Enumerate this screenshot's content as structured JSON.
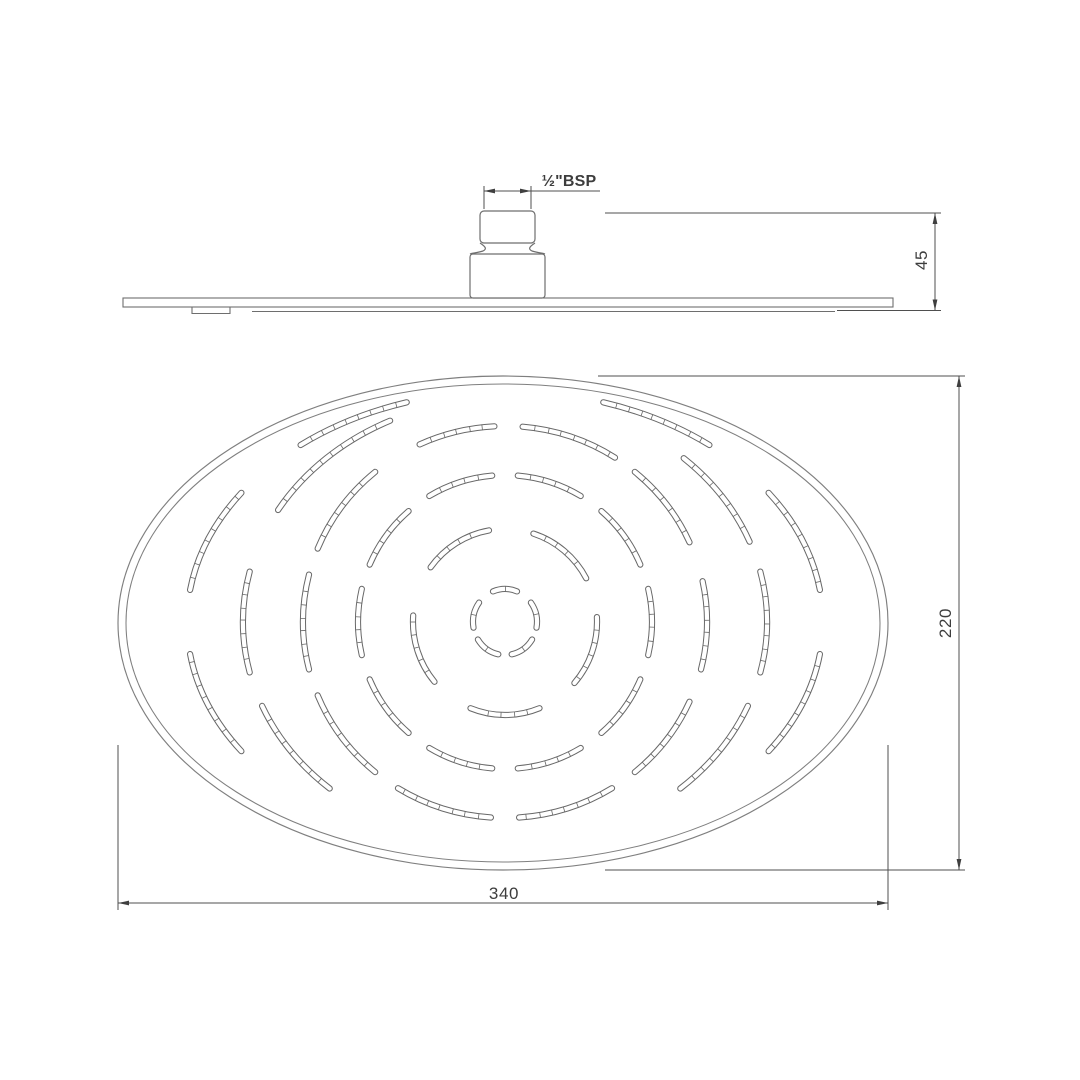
{
  "drawing": {
    "labels": {
      "thread": "½\"BSP",
      "connector_height": "45",
      "face_width": "340",
      "face_height": "220"
    },
    "colors": {
      "line": "#6e6e6e",
      "rim": "#7f7f7f",
      "slot": "#686868",
      "dim": "#4f4f4f",
      "arrow": "#3f3f3f",
      "text": "#3d3d3d",
      "background": "#ffffff"
    },
    "side_view": {
      "plate": {
        "x1": 123,
        "x2": 893,
        "y1": 298,
        "y2": 307
      },
      "under_line": {
        "x1": 252,
        "x2": 835,
        "y": 311.5
      },
      "under_tab": {
        "x1": 192,
        "x2": 230,
        "y1": 307,
        "y2": 313.5
      },
      "connector": {
        "upper": {
          "x": 480,
          "y": 211,
          "w": 55,
          "h": 32,
          "r": 4
        },
        "neck": {
          "top": 243,
          "bottom": 254,
          "in_left": 483,
          "in_right": 532
        },
        "lower": {
          "x": 470,
          "y": 254,
          "w": 75,
          "h": 44,
          "r": 3
        }
      }
    },
    "dimensions": {
      "bsp": {
        "ext": [
          {
            "x": 484,
            "y1": 186,
            "y2": 209
          },
          {
            "x": 531,
            "y1": 186,
            "y2": 209
          }
        ],
        "line": {
          "x1": 484,
          "x2": 600,
          "y": 191
        },
        "arrows": [
          {
            "x": 484,
            "y": 191,
            "dir": "l"
          },
          {
            "x": 531,
            "y": 191,
            "dir": "r"
          }
        ]
      },
      "h45": {
        "ext_h": [
          {
            "x1": 605,
            "x2": 941,
            "y": 213
          },
          {
            "x1": 837,
            "x2": 941,
            "y": 310.5
          }
        ],
        "line": {
          "x": 935,
          "y1": 213,
          "y2": 310.5
        },
        "arrows": [
          {
            "x": 935,
            "y": 213,
            "dir": "u"
          },
          {
            "x": 935,
            "y": 310.5,
            "dir": "d"
          }
        ]
      },
      "w340": {
        "ext_v": [
          {
            "x": 118,
            "y1": 745,
            "y2": 910
          },
          {
            "x": 888,
            "y1": 745,
            "y2": 910
          }
        ],
        "line": {
          "x1": 118,
          "x2": 888,
          "y": 903
        },
        "arrows": [
          {
            "x": 118,
            "y": 903,
            "dir": "l"
          },
          {
            "x": 888,
            "y": 903,
            "dir": "r"
          }
        ]
      },
      "h220": {
        "ext_h": [
          {
            "x1": 598,
            "x2": 965,
            "y": 376
          },
          {
            "x1": 605,
            "x2": 965,
            "y": 870
          }
        ],
        "line": {
          "x": 959,
          "y1": 376,
          "y2": 870
        },
        "arrows": [
          {
            "x": 959,
            "y": 376,
            "dir": "u"
          },
          {
            "x": 959,
            "y": 870,
            "dir": "d"
          }
        ]
      }
    },
    "face_view": {
      "cx": 503,
      "cy": 623,
      "outer": {
        "rx": 385,
        "ry": 247
      },
      "inner": {
        "rx": 377,
        "ry": 239
      },
      "pattern_center": {
        "x": 505,
        "y": 622
      },
      "slot_width_outer": 6.2,
      "slot_width_inner": 4.2,
      "tick_spacing": 13,
      "rings": [
        {
          "rx": 32,
          "ry": 33,
          "arcs": [
            [
              -112,
              -68
            ],
            [
              -36,
              10
            ],
            [
              32,
              78
            ],
            [
              102,
              148
            ],
            [
              170,
              216
            ]
          ]
        },
        {
          "rx": 92,
          "ry": 93,
          "arcs": [
            [
              -144,
              -100
            ],
            [
              -72,
              -28
            ],
            [
              -3,
              41
            ],
            [
              68,
              112
            ],
            [
              140,
              184
            ]
          ]
        },
        {
          "rx": 147,
          "ry": 147,
          "arcs": [
            [
              -121,
              -95
            ],
            [
              -85,
              -59
            ],
            [
              -49,
              -23
            ],
            [
              -13,
              13
            ],
            [
              23,
              49
            ],
            [
              59,
              85
            ],
            [
              95,
              121
            ],
            [
              131,
              157
            ],
            [
              167,
              193
            ],
            [
              203,
              229
            ]
          ]
        },
        {
          "rx": 202,
          "ry": 196,
          "arcs": [
            [
              -115,
              -93
            ],
            [
              -85,
              -57
            ],
            [
              -50,
              -24
            ],
            [
              -12,
              14
            ],
            [
              24,
              50
            ],
            [
              58,
              86
            ],
            [
              94,
              122
            ],
            [
              130,
              158
            ],
            [
              166,
              194
            ],
            [
              202,
              230
            ]
          ]
        },
        {
          "rx": 262,
          "ry": 224,
          "arcs": [
            [
              -150,
              -116
            ],
            [
              -47,
              -21
            ],
            [
              -13,
              13
            ],
            [
              22,
              48
            ],
            [
              132,
              158
            ],
            [
              167,
              193
            ]
          ]
        },
        {
          "rx": 318,
          "ry": 231,
          "arcs": [
            [
              -130,
              -108
            ],
            [
              -72,
              -50
            ],
            [
              -34,
              -8
            ],
            [
              8,
              34
            ],
            [
              146,
              172
            ],
            [
              188,
              214
            ]
          ]
        }
      ]
    }
  }
}
